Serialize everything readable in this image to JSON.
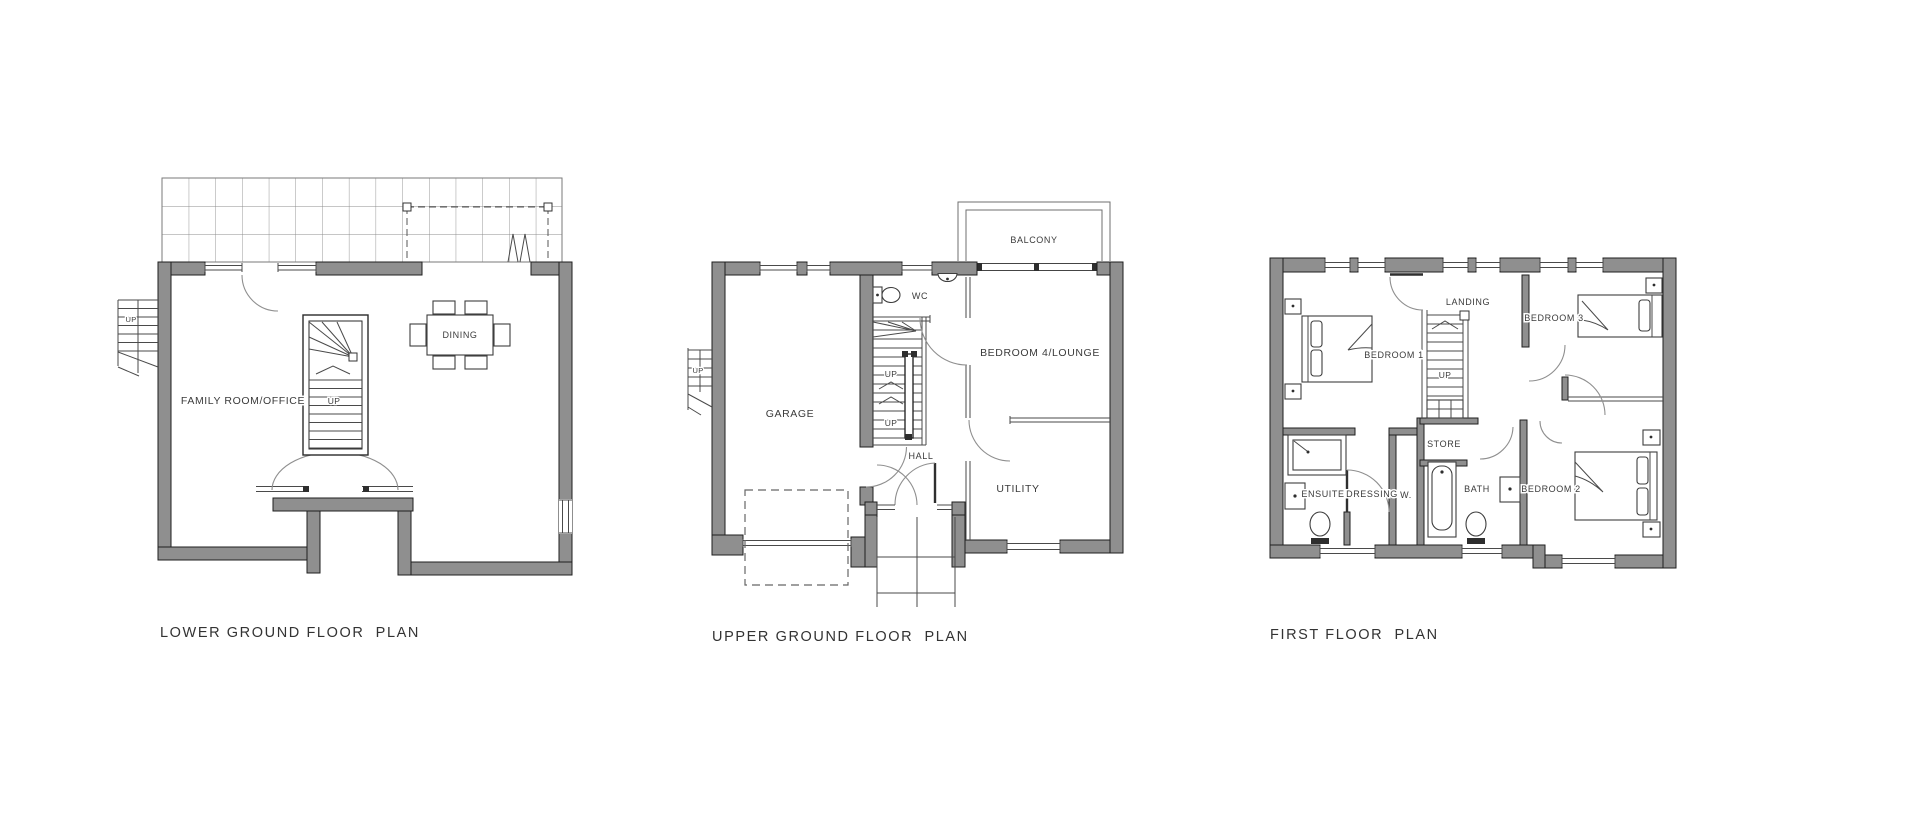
{
  "document": {
    "type": "architectural-floor-plan-sheet",
    "background": "#ffffff"
  },
  "colors": {
    "wall_fill": "#8f8f8f",
    "wall_outline": "#1f1f1f",
    "drawing_line": "#4a4a4a",
    "text": "#3b3b3b"
  },
  "plans": [
    {
      "title": "LOWER GROUND FLOOR  PLAN",
      "labels": {
        "family_room_office": "FAMILY ROOM/OFFICE",
        "dining": "DINING",
        "up_exterior_stair": "UP",
        "up_interior_stair": "UP"
      }
    },
    {
      "title": "UPPER GROUND FLOOR  PLAN",
      "labels": {
        "balcony": "BALCONY",
        "wc": "WC",
        "bedroom4_lounge": "BEDROOM 4/LOUNGE",
        "garage": "GARAGE",
        "hall": "HALL",
        "utility": "UTILITY",
        "up_exterior_stair": "UP",
        "up_stair_lower": "UP",
        "up_stair_upper": "UP"
      }
    },
    {
      "title": "FIRST FLOOR  PLAN",
      "labels": {
        "landing": "LANDING",
        "bedroom1": "BEDROOM 1",
        "bedroom3": "BEDROOM 3",
        "bedroom2": "BEDROOM 2",
        "ensuite": "ENSUITE",
        "dressing": "DRESSING",
        "wardrobe": "W.",
        "store": "STORE",
        "bath": "BATH",
        "up_stair": "UP"
      }
    }
  ]
}
